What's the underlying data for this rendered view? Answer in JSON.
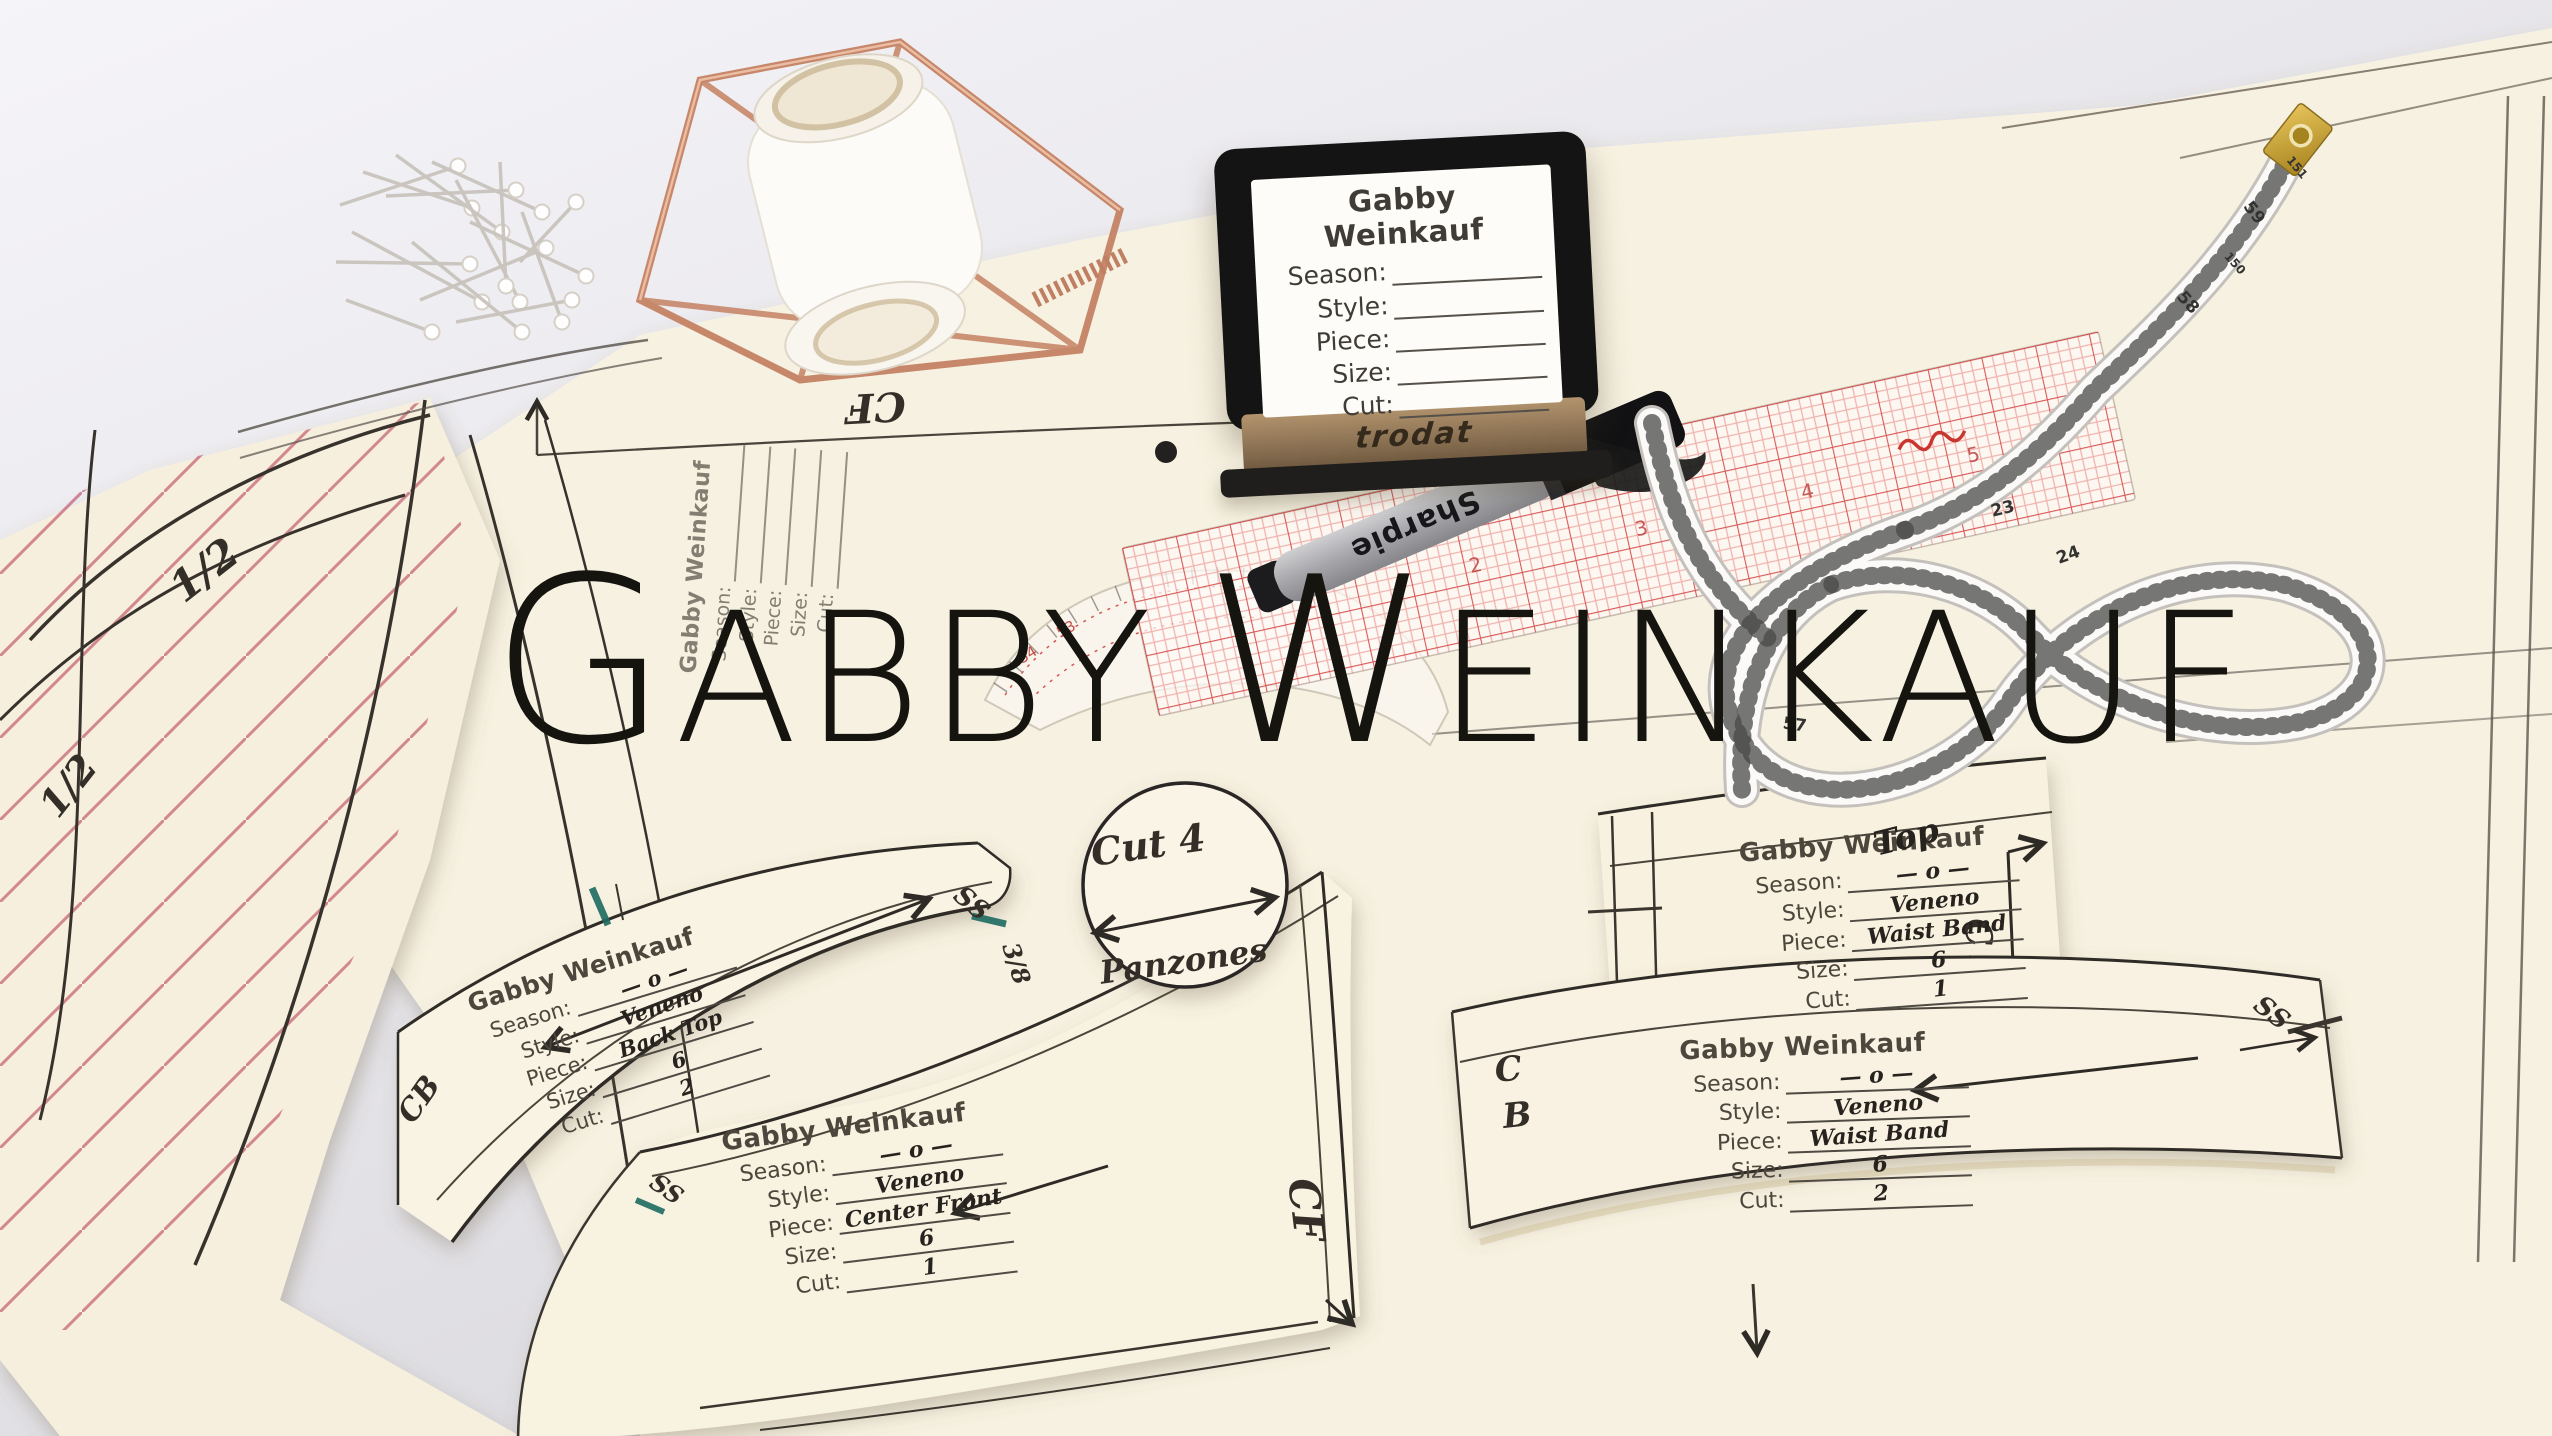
{
  "hero": {
    "part1": "G",
    "part2": "ABBY",
    "part3": "W",
    "part4": "EINKAUF"
  },
  "brands": {
    "stamp": "trodat",
    "marker": "Sharpie"
  },
  "stamps": [
    {
      "id": "stamp-tool-label",
      "title": "Gabby Weinkauf",
      "note": "",
      "fields": [
        [
          "Season:",
          ""
        ],
        [
          "Style:",
          ""
        ],
        [
          "Piece:",
          ""
        ],
        [
          "Size:",
          ""
        ],
        [
          "Cut:",
          ""
        ]
      ]
    },
    {
      "id": "imprint-blank",
      "title": "Gabby Weinkauf",
      "note": "",
      "fields": [
        [
          "Season:",
          ""
        ],
        [
          "Style:",
          ""
        ],
        [
          "Piece:",
          ""
        ],
        [
          "Size:",
          ""
        ],
        [
          "Cut:",
          ""
        ]
      ]
    },
    {
      "id": "imprint-back-top",
      "title": "Gabby Weinkauf",
      "note": "",
      "fields": [
        [
          "Season:",
          "— o —"
        ],
        [
          "Style:",
          "Veneno"
        ],
        [
          "Piece:",
          "Back Top"
        ],
        [
          "Size:",
          "6"
        ],
        [
          "Cut:",
          "2"
        ]
      ]
    },
    {
      "id": "imprint-center-front",
      "title": "Gabby Weinkauf",
      "note": "",
      "fields": [
        [
          "Season:",
          "— o —"
        ],
        [
          "Style:",
          "Veneno"
        ],
        [
          "Piece:",
          "Center Front"
        ],
        [
          "Size:",
          "6"
        ],
        [
          "Cut:",
          "1"
        ]
      ]
    },
    {
      "id": "imprint-waist-band-top",
      "title": "Gabby Weinkauf",
      "note": "Top",
      "fields": [
        [
          "Season:",
          "— o —"
        ],
        [
          "Style:",
          "Veneno"
        ],
        [
          "Piece:",
          "Waist Band"
        ],
        [
          "Size:",
          "6"
        ],
        [
          "Cut:",
          "1"
        ]
      ]
    },
    {
      "id": "imprint-waist-band-2",
      "title": "Gabby Weinkauf",
      "note": "",
      "fields": [
        [
          "Season:",
          "— o —"
        ],
        [
          "Style:",
          "Veneno"
        ],
        [
          "Piece:",
          "Waist Band"
        ],
        [
          "Size:",
          "6"
        ],
        [
          "Cut:",
          "2"
        ]
      ]
    }
  ],
  "labels": {
    "cf_grain": "CF",
    "cf_center": "CF",
    "cf_fold": "CF",
    "cb_back": "CB",
    "cb_waist_c": "C",
    "cb_waist_b": "B",
    "half_left1": "1/2",
    "half_left2": "1/2",
    "half_top": "1/2",
    "ss_back": "SS",
    "ss_front": "SS",
    "ss_waist": "SS",
    "seam_allowance": "3/8"
  },
  "circle_piece": {
    "line1": "Cut 4",
    "line2": "Panzones"
  },
  "tape": {
    "numbers": [
      "59",
      "58",
      "151",
      "150",
      "57",
      "23",
      "24"
    ]
  },
  "ruler": {
    "numbers": [
      "1",
      "2",
      "3",
      "4",
      "5"
    ]
  },
  "curve": {
    "numbers": [
      "54",
      "53"
    ]
  }
}
